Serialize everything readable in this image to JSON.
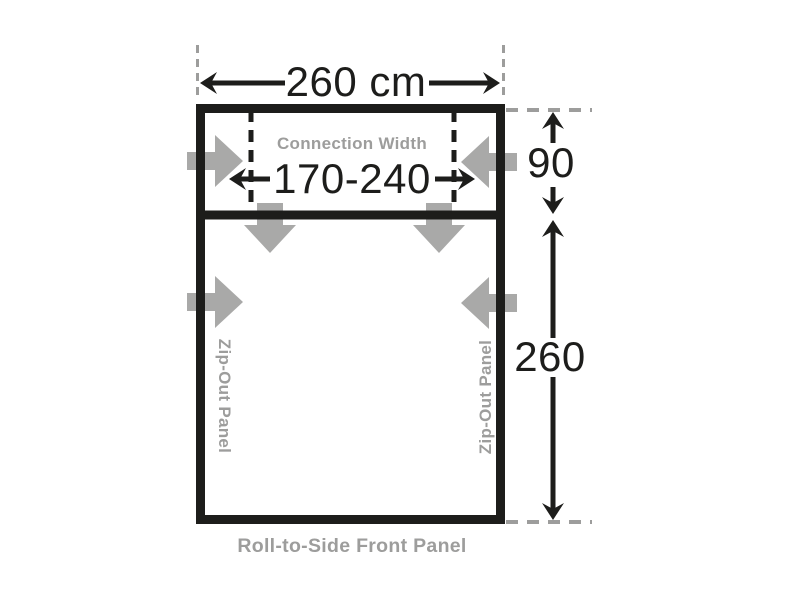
{
  "diagram": {
    "name": "awning-floorplan-dimensions",
    "width_label": "260 cm",
    "connection": {
      "label": "Connection Width",
      "value": "170-240"
    },
    "top_section_depth": "90",
    "main_section_depth": "260",
    "left_panel_label": "Zip-Out Panel",
    "right_panel_label": "Zip-Out Panel",
    "front_panel_label": "Roll-to-Side Front Panel",
    "colors": {
      "ink": "#1d1d1b",
      "label_gray": "#9d9d9c",
      "arrow_gray": "#a9a9a8",
      "background": "#ffffff"
    }
  }
}
